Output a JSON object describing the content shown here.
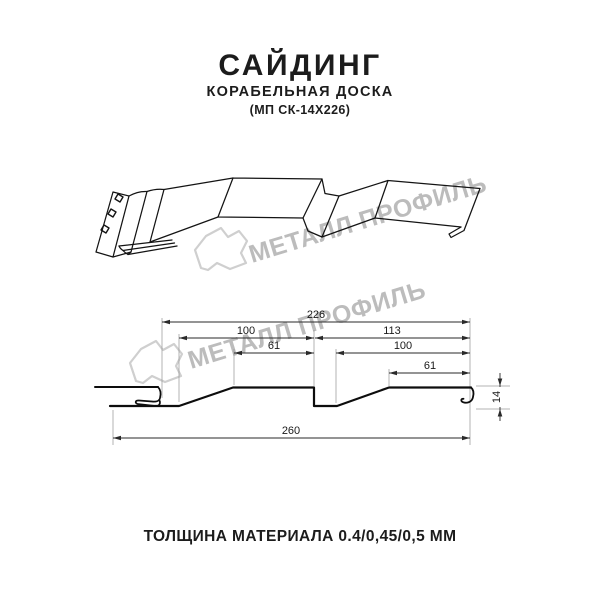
{
  "header": {
    "title": "САЙДИНГ",
    "subtitle": "КОРАБЕЛЬНАЯ ДОСКА",
    "model": "(МП СК-14Х226)"
  },
  "watermark": {
    "text": "МЕТАЛЛ ПРОФИЛЬ"
  },
  "cross_section": {
    "dims": {
      "module_width": "226",
      "board1_width": "100",
      "board2_width": "113",
      "board1_face": "61",
      "board2_inner": "100",
      "board2_face": "61",
      "total_width": "260",
      "profile_height": "14"
    }
  },
  "footer": {
    "thickness_note": "ТОЛЩИНА МАТЕРИАЛА 0.4/0,45/0,5 ММ"
  },
  "colors": {
    "line": "#141414",
    "dimension": "#2a2a2a",
    "extension": "#9a9a9a",
    "watermark": "#bcbcbc",
    "text": "#1c1c1c"
  }
}
